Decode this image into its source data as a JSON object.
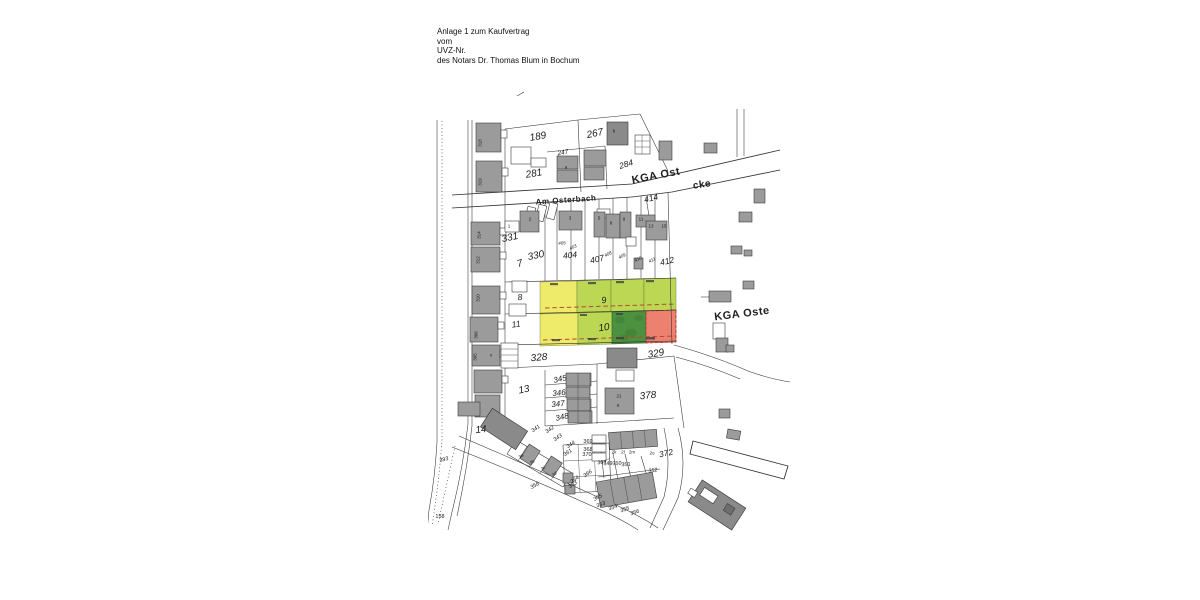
{
  "document": {
    "header_lines": [
      "Anlage 1 zum Kaufvertrag",
      "vom",
      "UVZ-Nr.",
      "des Notars Dr. Thomas Blum in Bochum"
    ]
  },
  "map": {
    "colors": {
      "highlight_yellow": "#eeeb6a",
      "highlight_light_green": "#bcd754",
      "highlight_dark_green": "#4c9140",
      "highlight_red": "#ed8170",
      "building_gray": "#9b9b9b",
      "line_dark": "#2e2e2e",
      "dashed_red": "#b34a2e"
    },
    "highlighted_parcels": [
      {
        "number": "9",
        "fills": [
          "yellow",
          "light_green"
        ]
      },
      {
        "number": "10",
        "fills": [
          "yellow",
          "light_green",
          "dark_green",
          "red"
        ]
      }
    ],
    "labels": [
      {
        "t": "Am Osterbach",
        "x": 566,
        "y": 200,
        "r": -4,
        "s": 8,
        "b": true
      },
      {
        "t": "KGA Ost",
        "x": 656,
        "y": 176,
        "r": -11,
        "s": 11,
        "b": true
      },
      {
        "t": "cke",
        "x": 702,
        "y": 185,
        "r": -8,
        "s": 10,
        "b": true
      },
      {
        "t": "KGA Oste",
        "x": 742,
        "y": 314,
        "r": -7,
        "s": 11,
        "b": true
      },
      {
        "t": "189",
        "x": 538,
        "y": 137,
        "r": -10,
        "s": 10
      },
      {
        "t": "267",
        "x": 595,
        "y": 134,
        "r": -12,
        "s": 10
      },
      {
        "t": "247",
        "x": 563,
        "y": 153,
        "r": -10,
        "s": 6.5
      },
      {
        "t": "284",
        "x": 626,
        "y": 164,
        "r": -17,
        "s": 8.5
      },
      {
        "t": "281",
        "x": 534,
        "y": 174,
        "r": -10,
        "s": 10
      },
      {
        "t": "414",
        "x": 651,
        "y": 198,
        "r": -13,
        "s": 8.5
      },
      {
        "t": "331",
        "x": 510,
        "y": 238,
        "r": -12,
        "s": 10
      },
      {
        "t": "7",
        "x": 520,
        "y": 264,
        "r": -18,
        "s": 10
      },
      {
        "t": "330",
        "x": 536,
        "y": 256,
        "r": -12,
        "s": 10
      },
      {
        "t": "404",
        "x": 570,
        "y": 255,
        "r": -6,
        "s": 8.5
      },
      {
        "t": "407",
        "x": 597,
        "y": 259,
        "r": -13,
        "s": 8.5
      },
      {
        "t": "412",
        "x": 667,
        "y": 261,
        "r": -13,
        "s": 8.5
      },
      {
        "t": "405",
        "x": 562,
        "y": 243,
        "r": -5,
        "s": 4.5
      },
      {
        "t": "403",
        "x": 573,
        "y": 247,
        "r": -25,
        "s": 4.5
      },
      {
        "t": "408",
        "x": 608,
        "y": 254,
        "r": -25,
        "s": 4.5
      },
      {
        "t": "409",
        "x": 622,
        "y": 256,
        "r": -25,
        "s": 4.5
      },
      {
        "t": "410",
        "x": 638,
        "y": 259,
        "r": -25,
        "s": 4.5
      },
      {
        "t": "411",
        "x": 652,
        "y": 260,
        "r": -25,
        "s": 4.5
      },
      {
        "t": "9",
        "x": 604,
        "y": 300,
        "r": -8,
        "s": 9
      },
      {
        "t": "10",
        "x": 604,
        "y": 328,
        "r": -8,
        "s": 10
      },
      {
        "t": "8",
        "x": 520,
        "y": 297,
        "r": -5,
        "s": 8.5
      },
      {
        "t": "11",
        "x": 516,
        "y": 324,
        "r": -8,
        "s": 8.5
      },
      {
        "t": "328",
        "x": 539,
        "y": 358,
        "r": -5,
        "s": 10
      },
      {
        "t": "329",
        "x": 656,
        "y": 354,
        "r": -10,
        "s": 10
      },
      {
        "t": "13",
        "x": 524,
        "y": 390,
        "r": -12,
        "s": 10
      },
      {
        "t": "345",
        "x": 560,
        "y": 379,
        "r": -12,
        "s": 8
      },
      {
        "t": "346",
        "x": 559,
        "y": 393,
        "r": -6,
        "s": 8
      },
      {
        "t": "347",
        "x": 558,
        "y": 404,
        "r": -6,
        "s": 8
      },
      {
        "t": "348",
        "x": 562,
        "y": 417,
        "r": -12,
        "s": 8
      },
      {
        "t": "378",
        "x": 648,
        "y": 396,
        "r": -6,
        "s": 10
      },
      {
        "t": "14",
        "x": 481,
        "y": 430,
        "r": -6,
        "s": 10
      },
      {
        "t": "372",
        "x": 666,
        "y": 453,
        "r": -12,
        "s": 8.5
      },
      {
        "t": "341",
        "x": 536,
        "y": 429,
        "r": -35,
        "s": 5.5
      },
      {
        "t": "342",
        "x": 550,
        "y": 430,
        "r": -35,
        "s": 5.5
      },
      {
        "t": "343",
        "x": 558,
        "y": 438,
        "r": -35,
        "s": 5.5
      },
      {
        "t": "344",
        "x": 571,
        "y": 445,
        "r": -35,
        "s": 5.5
      },
      {
        "t": "361",
        "x": 568,
        "y": 453,
        "r": -35,
        "s": 5.5
      },
      {
        "t": "369",
        "x": 588,
        "y": 442,
        "s": 5.5,
        "u": true
      },
      {
        "t": "368",
        "x": 588,
        "y": 450,
        "s": 5.5,
        "u": true
      },
      {
        "t": "370",
        "x": 587,
        "y": 455,
        "s": 5.5,
        "u": true
      },
      {
        "t": "367",
        "x": 602,
        "y": 463,
        "r": -5,
        "s": 5.5,
        "u": true
      },
      {
        "t": "349",
        "x": 608,
        "y": 464,
        "r": -3,
        "s": 5.5,
        "u": true
      },
      {
        "t": "350",
        "x": 617,
        "y": 464,
        "r": -3,
        "s": 5.5,
        "u": true
      },
      {
        "t": "351",
        "x": 626,
        "y": 465,
        "r": -3,
        "s": 5.5,
        "u": true
      },
      {
        "t": "352",
        "x": 653,
        "y": 471,
        "r": -8,
        "s": 5.5
      },
      {
        "t": "366",
        "x": 588,
        "y": 474,
        "r": -35,
        "s": 5.5
      },
      {
        "t": "364",
        "x": 575,
        "y": 480,
        "r": -35,
        "s": 5.5
      },
      {
        "t": "363",
        "x": 573,
        "y": 485,
        "r": -35,
        "s": 5.5
      },
      {
        "t": "365",
        "x": 598,
        "y": 498,
        "r": -30,
        "s": 5.5
      },
      {
        "t": "353",
        "x": 601,
        "y": 505,
        "r": -20,
        "s": 5.5
      },
      {
        "t": "354",
        "x": 613,
        "y": 508,
        "r": -20,
        "s": 5.5
      },
      {
        "t": "355",
        "x": 625,
        "y": 510,
        "r": -20,
        "s": 5.5
      },
      {
        "t": "356",
        "x": 635,
        "y": 513,
        "r": -20,
        "s": 5.5
      },
      {
        "t": "358",
        "x": 535,
        "y": 486,
        "r": -30,
        "s": 5.5
      },
      {
        "t": "393",
        "x": 444,
        "y": 460,
        "r": -15,
        "s": 5.5
      },
      {
        "t": "158",
        "x": 440,
        "y": 517,
        "s": 5.5,
        "u": true
      },
      {
        "t": "318",
        "x": 480,
        "y": 143,
        "r": -90,
        "s": 4.5,
        "u": true
      },
      {
        "t": "319",
        "x": 480,
        "y": 182,
        "r": -90,
        "s": 4.5,
        "u": true
      },
      {
        "t": "314",
        "x": 479,
        "y": 235,
        "r": -90,
        "s": 4.5,
        "u": true
      },
      {
        "t": "312",
        "x": 478,
        "y": 260,
        "r": -90,
        "s": 4.5,
        "u": true
      },
      {
        "t": "310",
        "x": 478,
        "y": 298,
        "r": -90,
        "s": 4.5,
        "u": true
      },
      {
        "t": "306",
        "x": 476,
        "y": 335,
        "r": -90,
        "s": 4.5,
        "u": true
      },
      {
        "t": "305",
        "x": 475,
        "y": 357,
        "r": -90,
        "s": 4.5,
        "u": true
      },
      {
        "t": "v",
        "x": 491,
        "y": 355,
        "s": 4.5,
        "u": true
      },
      {
        "t": "2k",
        "x": 614,
        "y": 452,
        "s": 4.5,
        "u": true
      },
      {
        "t": "2l",
        "x": 623,
        "y": 452,
        "s": 4.5,
        "u": true
      },
      {
        "t": "2m",
        "x": 632,
        "y": 452,
        "s": 4.5,
        "u": true
      },
      {
        "t": "2o",
        "x": 652,
        "y": 453,
        "s": 4.5,
        "u": true
      },
      {
        "t": "3a",
        "x": 521,
        "y": 456,
        "r": -35,
        "s": 4.5
      },
      {
        "t": "3b",
        "x": 532,
        "y": 462,
        "r": -35,
        "s": 4.5
      },
      {
        "t": "3c",
        "x": 543,
        "y": 468,
        "r": -35,
        "s": 4.5
      },
      {
        "t": "3d",
        "x": 554,
        "y": 474,
        "r": -35,
        "s": 4.5
      },
      {
        "t": "2",
        "x": 530,
        "y": 219,
        "s": 4.5,
        "u": true
      },
      {
        "t": "3",
        "x": 570,
        "y": 218,
        "s": 4.5,
        "u": true
      },
      {
        "t": "5",
        "x": 599,
        "y": 218,
        "s": 4.5,
        "u": true
      },
      {
        "t": "8",
        "x": 611,
        "y": 223,
        "s": 4.5,
        "u": true
      },
      {
        "t": "9",
        "x": 624,
        "y": 219,
        "s": 4.5,
        "u": true
      },
      {
        "t": "11",
        "x": 641,
        "y": 219,
        "s": 4.5,
        "u": true
      },
      {
        "t": "13",
        "x": 651,
        "y": 226,
        "s": 4.5,
        "u": true
      },
      {
        "t": "15",
        "x": 664,
        "y": 226,
        "s": 4.5,
        "u": true
      },
      {
        "t": "a",
        "x": 566,
        "y": 167,
        "s": 4.5,
        "u": true
      },
      {
        "t": "b",
        "x": 614,
        "y": 131,
        "s": 4.5,
        "u": true
      },
      {
        "t": "21",
        "x": 619,
        "y": 396,
        "s": 4.5,
        "u": true
      },
      {
        "t": "a",
        "x": 618,
        "y": 405,
        "s": 4.5,
        "u": true
      },
      {
        "t": "1",
        "x": 509,
        "y": 226,
        "s": 4.5,
        "u": true
      }
    ]
  }
}
